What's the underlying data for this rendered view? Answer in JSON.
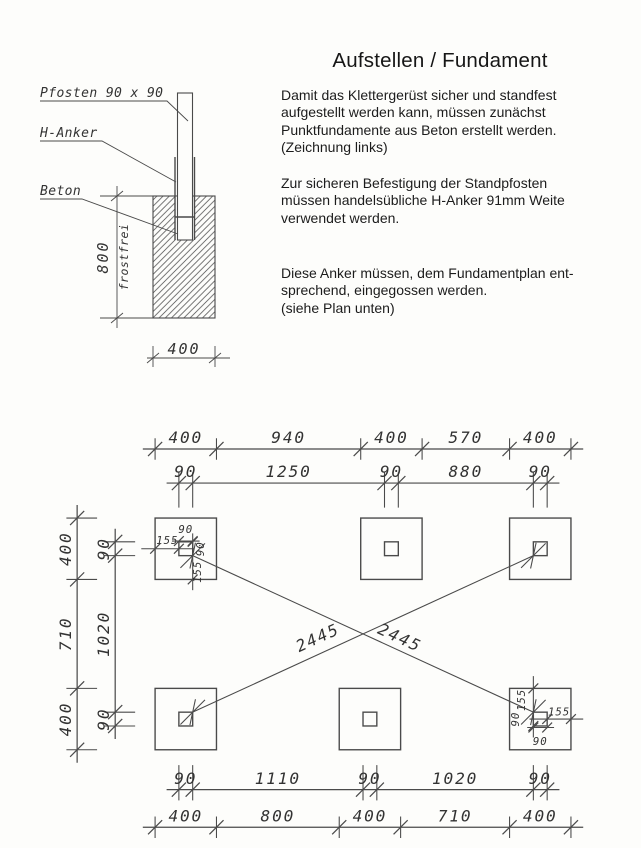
{
  "header": {
    "title": "Aufstellen / Fundament"
  },
  "paragraphs": {
    "p1": "Damit das Klettergerüst sicher und standfest\naufgestellt werden kann, müssen zunächst\nPunktfundamente aus Beton erstellt werden.\n(Zeichnung links)",
    "p2": "Zur sicheren Befestigung der Standpfosten\nmüssen handelsübliche H-Anker 91mm Weite\nverwendet werden.",
    "p3": "Diese Anker müssen, dem Fundamentplan ent-\nsprechend, eingegossen werden.\n(siehe Plan unten)"
  },
  "elevation": {
    "labels": {
      "post": "Pfosten 90 x 90",
      "anchor": "H-Anker",
      "concrete": "Beton"
    },
    "depth_label": "800",
    "depth_note": "frostfrei",
    "width_label": "400"
  },
  "plan": {
    "foundation_size": 400,
    "anchor_size": 90,
    "anchor_offset": 155,
    "columns_top": [
      0,
      1340,
      2310
    ],
    "columns_bottom": [
      0,
      1200,
      2310
    ],
    "rows_y": [
      0,
      1110
    ],
    "dim_rows": [
      {
        "id": "top-outer",
        "y": -450,
        "ext": 70,
        "ticks": [
          0,
          400,
          1340,
          1740,
          2310,
          2710
        ],
        "labels": [
          "400",
          "940",
          "400",
          "570",
          "400"
        ]
      },
      {
        "id": "top-anchor",
        "y": -228,
        "ext": 160,
        "ticks": [
          155,
          245,
          1495,
          1585,
          2465,
          2555
        ],
        "labels": [
          "90",
          "1250",
          "90",
          "880",
          "90"
        ]
      },
      {
        "id": "bottom-anchor",
        "y": 1770,
        "ext": -160,
        "ticks": [
          155,
          245,
          1355,
          1445,
          2465,
          2555
        ],
        "labels": [
          "90",
          "1110",
          "90",
          "1020",
          "90"
        ]
      },
      {
        "id": "bottom-outer",
        "y": 2015,
        "ext": 70,
        "ticks": [
          0,
          400,
          1200,
          1600,
          2310,
          2710
        ],
        "labels": [
          "400",
          "800",
          "400",
          "710",
          "400"
        ]
      }
    ],
    "dim_cols": [
      {
        "id": "left-outer",
        "x": -508,
        "ticks": [
          0,
          400,
          1110,
          1510
        ],
        "labels": [
          "400",
          "710",
          "400"
        ]
      },
      {
        "id": "left-anchor",
        "x": -260,
        "ticks": [
          155,
          245,
          1265,
          1355
        ],
        "labels": [
          "90",
          "1020",
          "90"
        ]
      }
    ],
    "diagonal_label": "2445",
    "detail_dims_tl": {
      "top": "90",
      "left": "155",
      "right": "90",
      "bottom": "155"
    },
    "detail_dims_br": {
      "top": "155",
      "left": "90",
      "right": "155",
      "bottom": "90"
    }
  },
  "colors": {
    "line": "#4a4a4a",
    "cad_text": "#333333",
    "body_text": "#1c1c1c",
    "paper": "#fdfdfb"
  }
}
